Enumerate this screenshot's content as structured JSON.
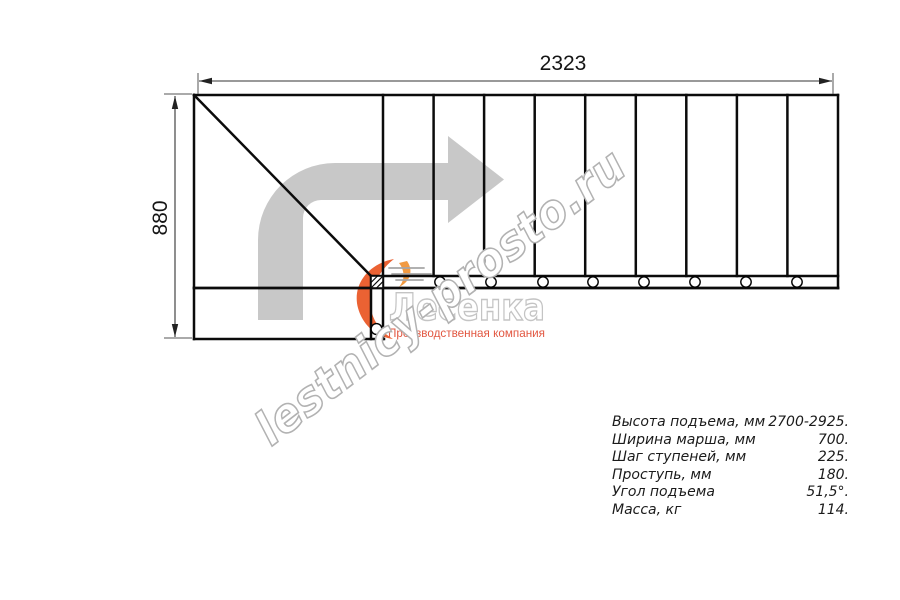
{
  "drawing": {
    "top_dimension_label": "2323",
    "left_dimension_label": "880"
  },
  "watermark": {
    "text": "lestnicy-prosto.ru"
  },
  "logo": {
    "name": "Лесенка",
    "tagline": "Производственная компания"
  },
  "specs": {
    "rows": [
      {
        "label": "Высота подъема, мм",
        "value": "2700-2925."
      },
      {
        "label": "Ширина марша, мм",
        "value": "700."
      },
      {
        "label": "Шаг ступеней, мм",
        "value": "225."
      },
      {
        "label": "Проступь, мм",
        "value": "180."
      },
      {
        "label": "Угол подъема",
        "value": "51,5°."
      },
      {
        "label": "Масса, кг",
        "value": "114."
      }
    ]
  },
  "colors": {
    "outline_black": "#0b0b0b",
    "dimension_gray": "#333333",
    "direction_arrow_gray": "#c8c8c8",
    "watermark_gray": "#b2b2b2",
    "logo_text_gray": "#c4c4c4",
    "logo_accent_orange": "#eb6233",
    "logo_accent_light": "#f19a41",
    "tagline_salmon": "#e25741"
  }
}
